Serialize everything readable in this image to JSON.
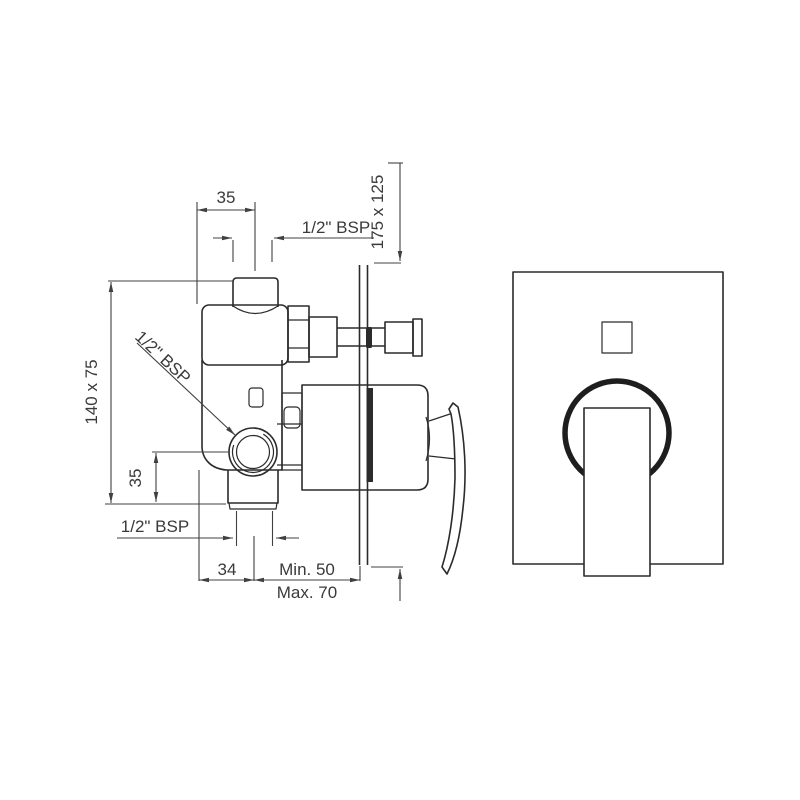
{
  "drawing": {
    "kind": "concealed-shower-mixer-installation-drawing",
    "background": "#ffffff",
    "line_color": "#2b2b2b",
    "dimension_color": "#404040",
    "side_view": {
      "labels": {
        "top_offset": "35",
        "top_port_thread": "1/2\" BSP",
        "plate_size": "175 x 125",
        "body_size": "140 x 75",
        "side_port_thread": "1/2\" BSP",
        "side_port_offset": "35",
        "bottom_port_thread": "1/2\" BSP",
        "bottom_offset": "34",
        "depth_min": "Min. 50",
        "depth_max": "Max. 70"
      }
    },
    "front_view": {
      "features": [
        "wall-plate",
        "diverter-window",
        "escutcheon-ring",
        "lever-handle"
      ]
    }
  }
}
